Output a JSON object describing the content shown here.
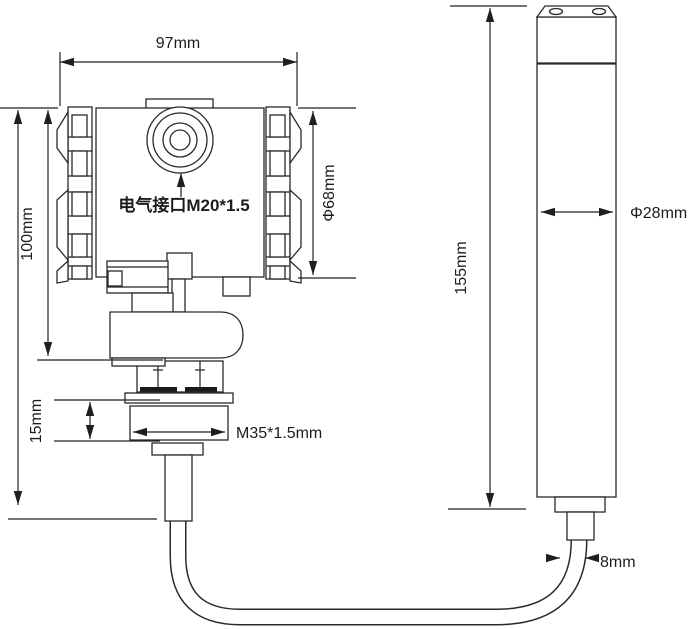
{
  "figure": {
    "transmitter": {
      "electrical_port_label": "电气接口M20*1.5",
      "thread_label": "M35*1.5mm",
      "dim_width": "97mm",
      "dim_height": "100mm",
      "dim_cap_diameter": "Φ68mm",
      "dim_thread_height": "15mm"
    },
    "probe": {
      "dim_length": "155mm",
      "dim_diameter": "Φ28mm",
      "dim_cable_diameter": "8mm"
    }
  }
}
